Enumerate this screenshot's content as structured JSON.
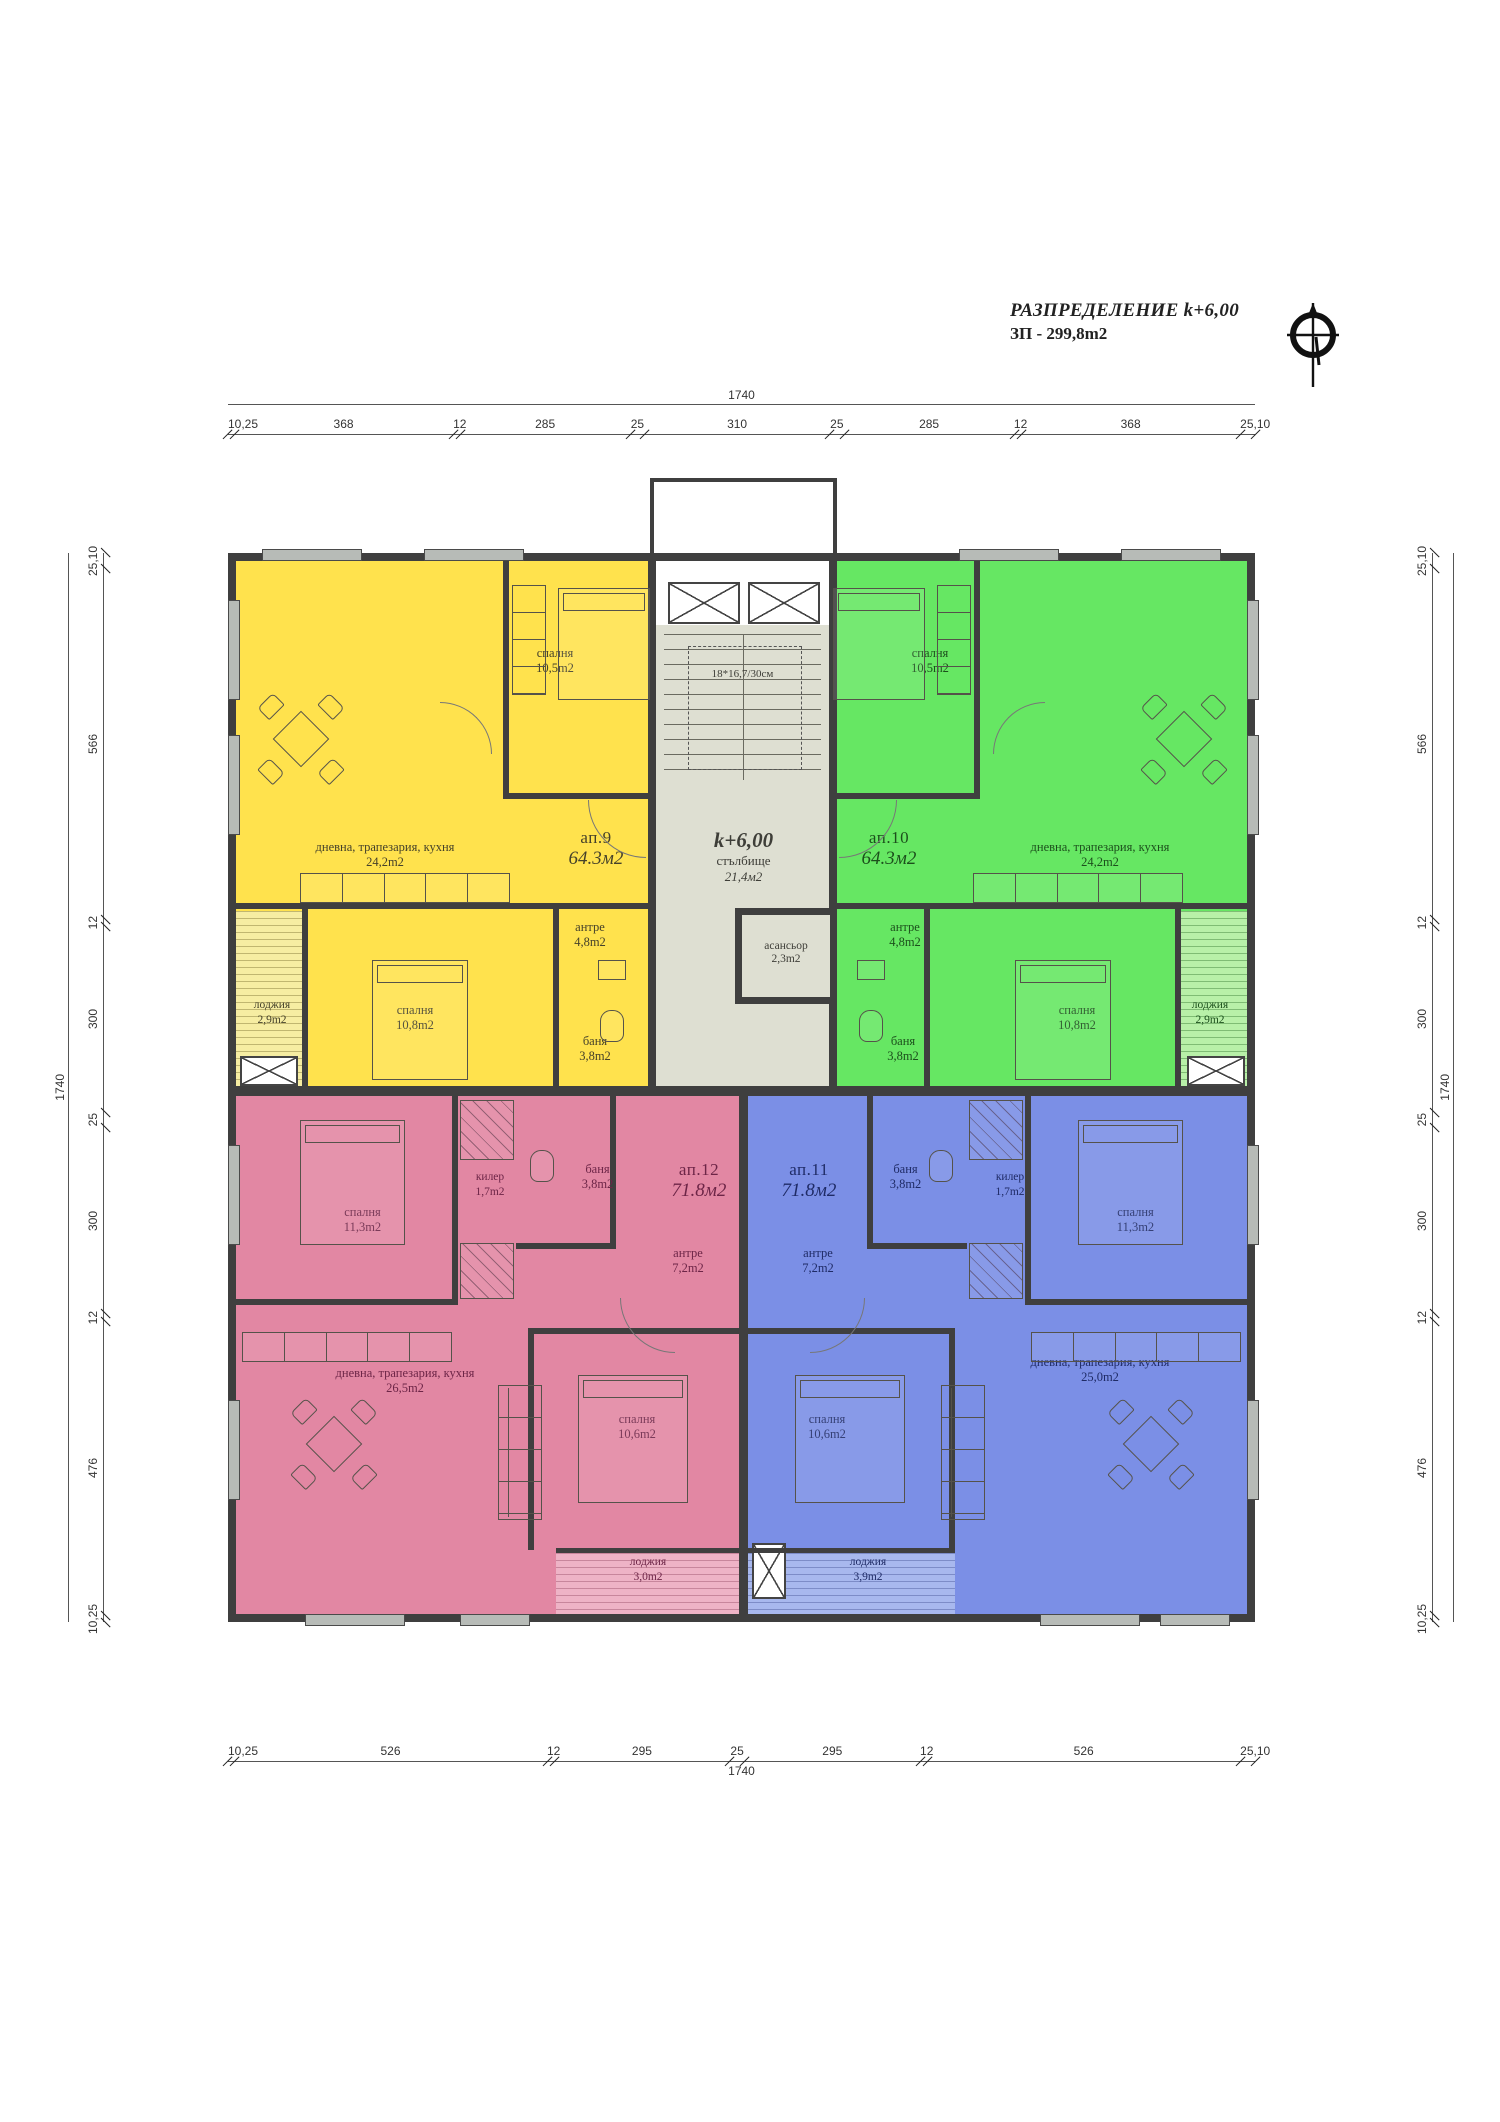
{
  "title": {
    "line1": "РАЗПРЕДЕЛЕНИЕ k+6,00",
    "line2": "ЗП - 299,8m2"
  },
  "icons": {
    "compass": "north-arrow-compass"
  },
  "colors": {
    "ap9_fill": "#ffe24d",
    "ap10_fill": "#66e763",
    "ap11_fill": "#7b8fe6",
    "ap12_fill": "#e287a3",
    "core_fill": "#dedfd2",
    "wall": "#3f3f3f",
    "window_fill": "#b7bbb7"
  },
  "dimensions": {
    "top": {
      "total": "1740",
      "segments": [
        "10,25",
        "368",
        "12",
        "285",
        "25",
        "310",
        "25",
        "285",
        "12",
        "368",
        "25,10"
      ]
    },
    "bottom": {
      "total": "1740",
      "segments": [
        "10,25",
        "526",
        "12",
        "295",
        "25",
        "295",
        "12",
        "526",
        "25,10"
      ]
    },
    "left": {
      "total": "1740",
      "segments": [
        "25,10",
        "566",
        "12",
        "300",
        "25",
        "300",
        "12",
        "476",
        "10,25"
      ]
    },
    "right": {
      "total": "1740",
      "segments": [
        "25,10",
        "566",
        "12",
        "300",
        "25",
        "300",
        "12",
        "476",
        "10,25"
      ]
    }
  },
  "core": {
    "level": "k+6,00",
    "stair": "стълбище",
    "stair_area": "21,4м2",
    "steps": "18*16,7/30см",
    "elevator": "асансьор",
    "elevator_area": "2,3m2"
  },
  "apartments": {
    "ap9": {
      "id": "ап.9",
      "area": "64.3м2",
      "bedroom1": {
        "name": "спалня",
        "area": "10,5m2"
      },
      "living": {
        "name": "дневна, трапезария, кухня",
        "area": "24,2m2"
      },
      "hall": {
        "name": "антре",
        "area": "4,8m2"
      },
      "bedroom2": {
        "name": "спалня",
        "area": "10,8m2"
      },
      "bath": {
        "name": "баня",
        "area": "3,8m2"
      },
      "loggia": {
        "name": "лоджия",
        "area": "2,9m2"
      }
    },
    "ap10": {
      "id": "ап.10",
      "area": "64.3м2",
      "bedroom1": {
        "name": "спалня",
        "area": "10,5m2"
      },
      "living": {
        "name": "дневна, трапезария, кухня",
        "area": "24,2m2"
      },
      "hall": {
        "name": "антре",
        "area": "4,8m2"
      },
      "bedroom2": {
        "name": "спалня",
        "area": "10,8m2"
      },
      "bath": {
        "name": "баня",
        "area": "3,8m2"
      },
      "loggia": {
        "name": "лоджия",
        "area": "2,9m2"
      }
    },
    "ap12": {
      "id": "ап.12",
      "area": "71.8м2",
      "bedroom1": {
        "name": "спалня",
        "area": "11,3m2"
      },
      "closet": {
        "name": "килер",
        "area": "1,7m2"
      },
      "bath": {
        "name": "баня",
        "area": "3,8m2"
      },
      "hall": {
        "name": "антре",
        "area": "7,2m2"
      },
      "living": {
        "name": "дневна, трапезария, кухня",
        "area": "26,5m2"
      },
      "bedroom2": {
        "name": "спалня",
        "area": "10,6m2"
      },
      "loggia": {
        "name": "лоджия",
        "area": "3,0m2"
      }
    },
    "ap11": {
      "id": "ап.11",
      "area": "71.8м2",
      "bedroom1": {
        "name": "спалня",
        "area": "11,3m2"
      },
      "closet": {
        "name": "килер",
        "area": "1,7m2"
      },
      "bath": {
        "name": "баня",
        "area": "3,8m2"
      },
      "hall": {
        "name": "антре",
        "area": "7,2m2"
      },
      "living": {
        "name": "дневна, трапезария, кухня",
        "area": "25,0m2"
      },
      "bedroom2": {
        "name": "спалня",
        "area": "10,6m2"
      },
      "loggia": {
        "name": "лоджия",
        "area": "3,9m2"
      }
    }
  }
}
